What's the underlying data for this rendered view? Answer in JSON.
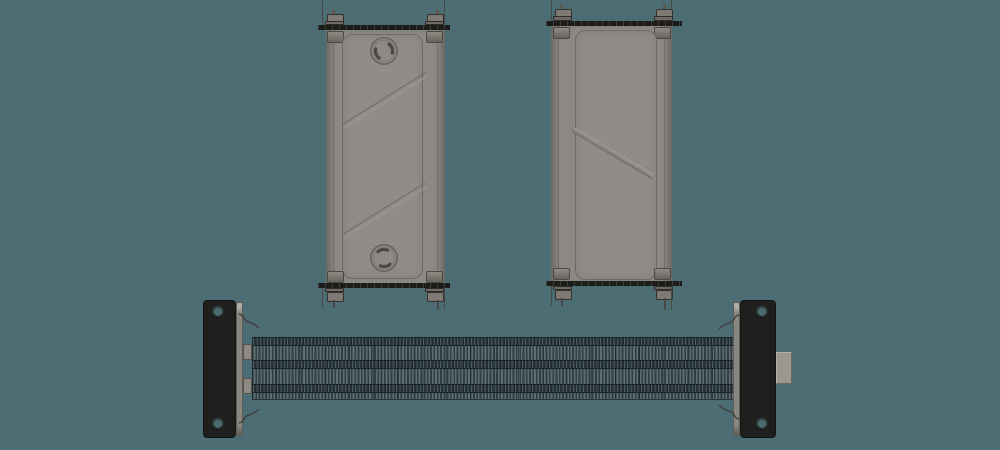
{
  "scene": {
    "colors": {
      "background": "#4d6d75",
      "panel": "#8c8984",
      "plate": "#908d88",
      "dark": "#1c1c1b",
      "nut": "#7e7a73",
      "rod": "#4a4945",
      "fin_dark": "#333e43",
      "fin_light": "#5d6d74",
      "band_dark": "#1f2a2f",
      "flange": "#1f1f1e",
      "bevel": "#8a8781",
      "tab": "#8d8a84",
      "block": "#9b9791",
      "wire": "#403e3a",
      "ridge_highlight": "#a6a39d",
      "ridge_shadow": "#6a6761"
    },
    "counts": {
      "panel_views": 2,
      "circular_ports_front_view": 2,
      "diagonal_ribs_front_view": 2,
      "diagonal_ribs_back_view": 1,
      "studs_per_panel": 4,
      "flange_holes_per_side": 2,
      "fin_pitch_px": 3.3,
      "wire_clips": 4
    }
  }
}
